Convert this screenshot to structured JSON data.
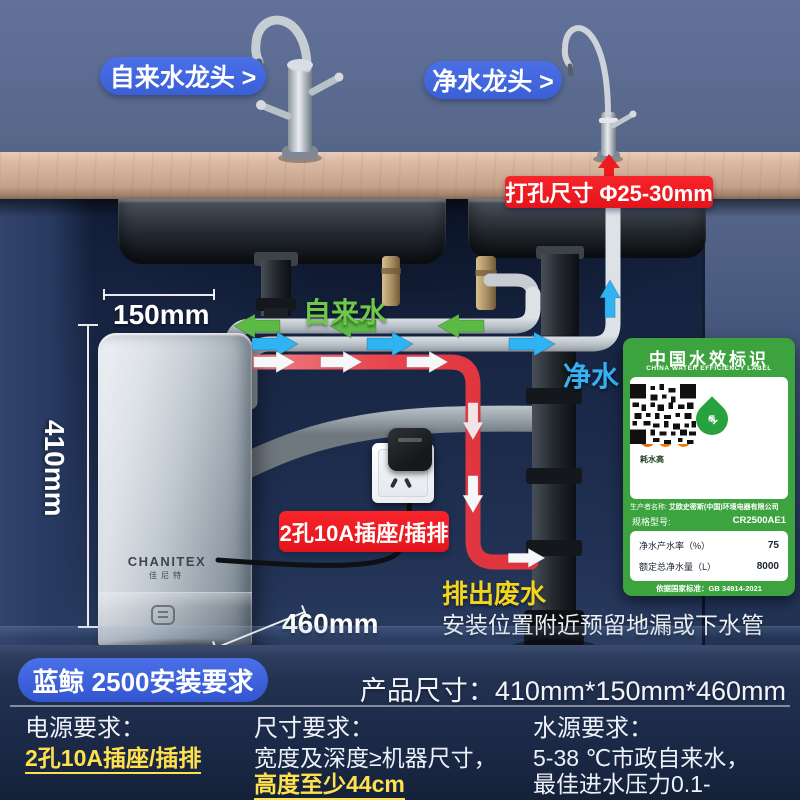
{
  "colors": {
    "accent_blue": "#3e66dc",
    "label_red": "#ee1c24",
    "flow_green": "#5cb944",
    "flow_blue": "#2fb3f2",
    "flow_red": "#e6434b",
    "highlight_yellow": "#ffe14d",
    "efficiency_green": "#3da33f"
  },
  "callouts": {
    "tap_faucet": "自来水龙头 >",
    "pure_faucet": "净水龙头 >",
    "hole_size": "打孔尺寸 Φ25-30mm",
    "socket": "2孔10A插座/插排",
    "waste": "排出废水",
    "install_note": "安装位置附近预留地漏或下水管"
  },
  "flows": {
    "tap": "自来水",
    "pure": "净水"
  },
  "dimensions": {
    "width": "150mm",
    "height": "410mm",
    "depth": "460mm"
  },
  "device": {
    "brand": "CHANITEX",
    "brand_cn": "佳尼特"
  },
  "efficiency_label": {
    "title": "中国水效标识",
    "subtitle": "CHINA WATER EFFICIENCY LABEL",
    "low": "耗水低",
    "high": "耗水高",
    "drop_levels": [
      "1",
      "2",
      "3"
    ],
    "grade_num": "1",
    "grade_unit": "级",
    "producer_label": "生产者名称:",
    "producer": "艾欧史密斯(中国)环境电器有限公司",
    "model_label": "规格型号:",
    "model": "CR2500AE1",
    "rows": [
      {
        "name": "净水产水率（%）",
        "value": "75"
      },
      {
        "name": "额定总净水量（L）",
        "value": "8000"
      }
    ],
    "standard": "依据国家标准：GB 34914-2021"
  },
  "footer": {
    "title": "蓝鲸 2500安装要求",
    "product_size_label": "产品尺寸：",
    "product_size": "410mm*150mm*460mm",
    "columns": [
      {
        "title": "电源要求：",
        "lines": [
          {
            "text": "2孔10A插座/插排",
            "highlight": true
          }
        ]
      },
      {
        "title": "尺寸要求：",
        "lines": [
          {
            "text": "宽度及深度≥机器尺寸，",
            "highlight": false
          },
          {
            "text": "高度至少44cm",
            "highlight": true
          }
        ]
      },
      {
        "title": "水源要求：",
        "lines": [
          {
            "text": "5-38 ℃市政自来水，",
            "highlight": false
          },
          {
            "text": "最佳进水压力0.1-0.35MPa",
            "highlight": false
          }
        ]
      }
    ]
  }
}
